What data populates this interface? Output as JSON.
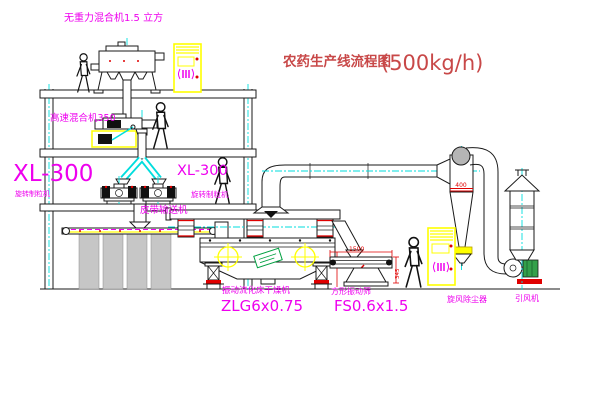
{
  "drawing": {
    "title": "农药生产线流程图",
    "capacity": "(500kg/h)",
    "machines": {
      "gravity_mixer": {
        "label": "无重力混合机1.5 立方"
      },
      "high_speed_mixer": {
        "label": "高速混合机350"
      },
      "granulator_left": {
        "model": "XL-300",
        "name": "旋转制粒机"
      },
      "granulator_right": {
        "model": "XL-300",
        "name": "旋转制粒机"
      },
      "belt_conveyor": {
        "label": "皮带输送机"
      },
      "fluidbed_dryer": {
        "name": "振动流化床干燥机",
        "model": "ZLG6x0.75"
      },
      "vibrating_sieve": {
        "name": "方形振动筛",
        "model": "FS0.6x1.5"
      },
      "cyclone": {
        "name": "旋风除尘器",
        "marking": "400"
      },
      "draft_fan": {
        "name": "引风机"
      }
    },
    "dimensions": {
      "sieve_length": "1500",
      "sieve_height": "345"
    },
    "colors": {
      "label_magenta": "#ee00ee",
      "title_red": "#c84848",
      "dimension_red": "#e00000",
      "pipe_cyan": "#00dddd",
      "cabinet_yellow": "#ffff00"
    }
  }
}
